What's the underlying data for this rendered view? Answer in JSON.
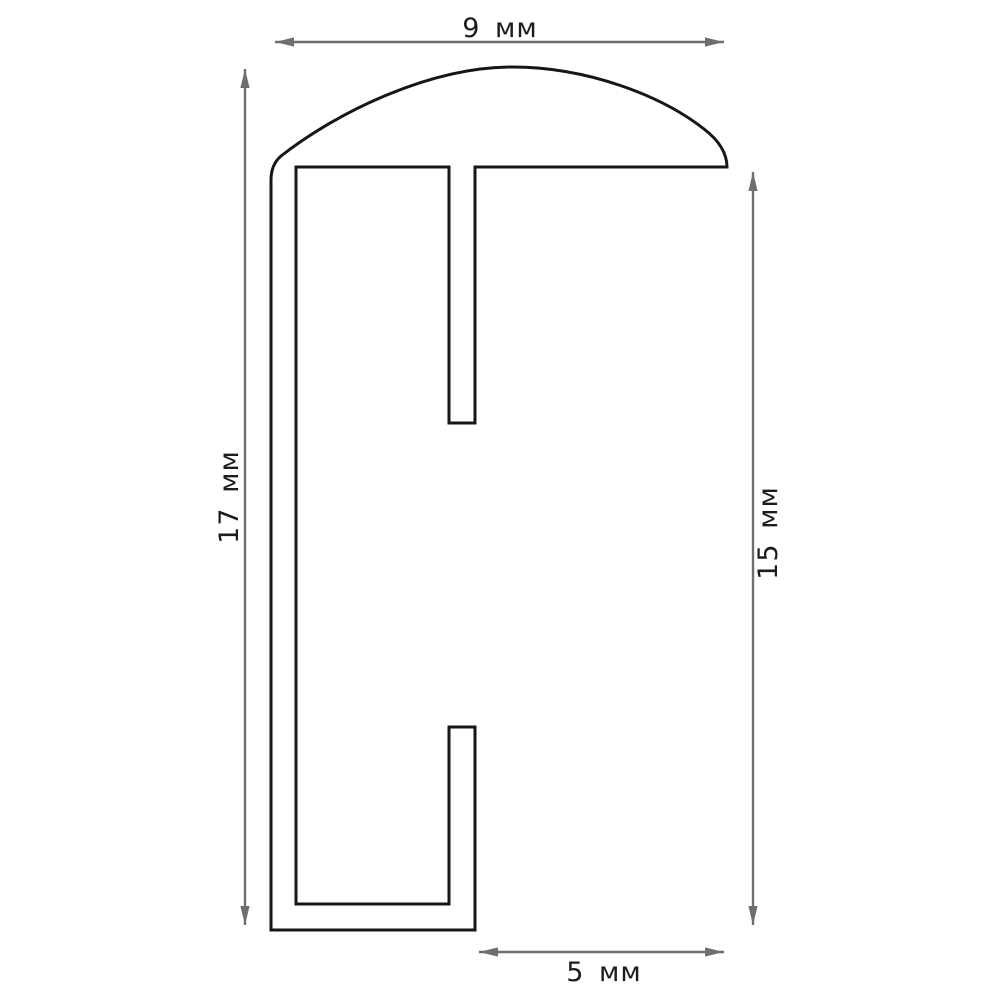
{
  "drawing": {
    "description": "Technical cross-section drawing of a frame moulding profile with dimension arrows",
    "unit": "мм",
    "dimensions": {
      "top": {
        "label": "9 мм",
        "value": 9,
        "orientation": "horizontal"
      },
      "left": {
        "label": "17 мм",
        "value": 17,
        "orientation": "vertical"
      },
      "right": {
        "label": "15 мм",
        "value": 15,
        "orientation": "vertical"
      },
      "bottom": {
        "label": "5 мм",
        "value": 5,
        "orientation": "horizontal"
      }
    },
    "colors": {
      "outline": "#161616",
      "dimension_line": "#6e6e6e",
      "label_text": "#1c1c1c",
      "background": "#ffffff"
    }
  }
}
